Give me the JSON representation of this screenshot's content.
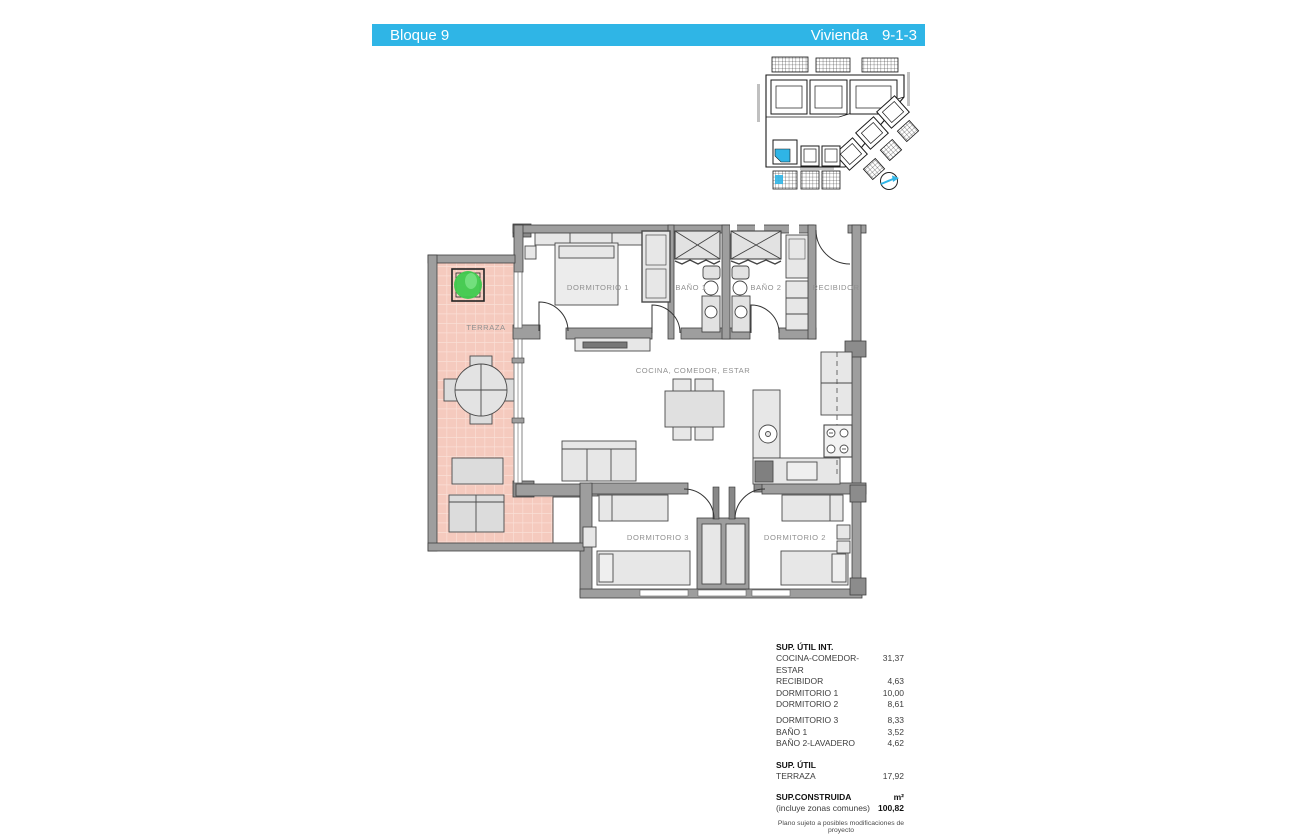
{
  "header": {
    "left": "Bloque 9",
    "right_label": "Vivienda",
    "right_value": "9-1-3"
  },
  "colors": {
    "accent": "#2fb5e6",
    "terrace_tile": "#f5cabe",
    "wall_gray": "#9e9e9e",
    "plant_green": "#3fca4e",
    "label_gray": "#909090"
  },
  "floor_plan": {
    "labels": {
      "terraza": "TERRAZA",
      "dormitorio1": "DORMITORIO 1",
      "bano1": "BAÑO 1",
      "bano2": "BAÑO 2",
      "recibidor": "RECIBIDOR",
      "cocina": "COCINA, COMEDOR, ESTAR",
      "dormitorio3": "DORMITORIO 3",
      "dormitorio2": "DORMITORIO 2"
    }
  },
  "areas_table": {
    "section_int": {
      "title": "SUP. ÚTIL INT.",
      "rows": [
        {
          "label": "COCINA-COMEDOR-ESTAR",
          "value": "31,37"
        },
        {
          "label": "RECIBIDOR",
          "value": "4,63"
        },
        {
          "label": "DORMITORIO 1",
          "value": "10,00"
        },
        {
          "label": "DORMITORIO 2",
          "value": "8,61"
        },
        {
          "label": "DORMITORIO 3",
          "value": "8,33"
        },
        {
          "label": "BAÑO 1",
          "value": "3,52"
        },
        {
          "label": "BAÑO 2-LAVADERO",
          "value": "4,62"
        }
      ]
    },
    "section_util": {
      "title": "SUP. ÚTIL",
      "rows": [
        {
          "label": "TERRAZA",
          "value": "17,92"
        }
      ]
    },
    "constructed": {
      "title": "SUP.CONSTRUIDA",
      "unit": "m²",
      "subtitle": "(incluye zonas comunes)",
      "value": "100,82"
    },
    "note": "Plano sujeto a posibles modificaciones de proyecto"
  }
}
